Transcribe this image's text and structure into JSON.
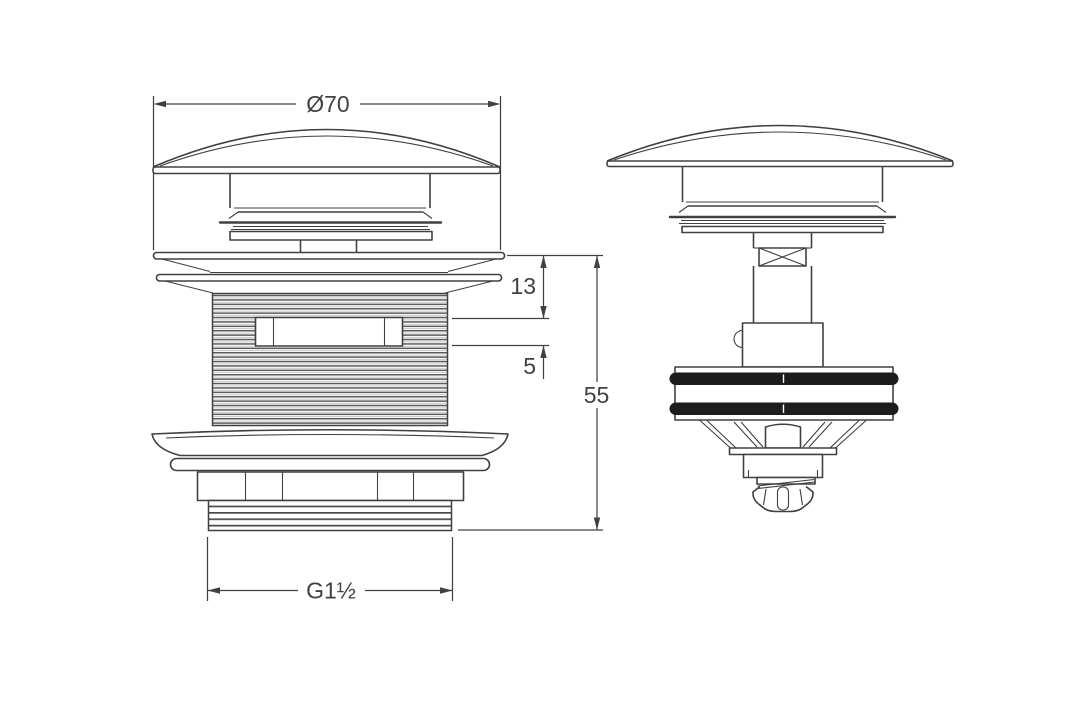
{
  "figure": {
    "background_color": "#ffffff",
    "line_color": "#404042",
    "oring_color": "#1d1d1d",
    "text_color": "#414042",
    "dimensions": {
      "cap_diameter": "Ø70",
      "flange_height": "13",
      "slot_offset": "5",
      "overall_height": "55",
      "thread_size": "G1½"
    }
  }
}
